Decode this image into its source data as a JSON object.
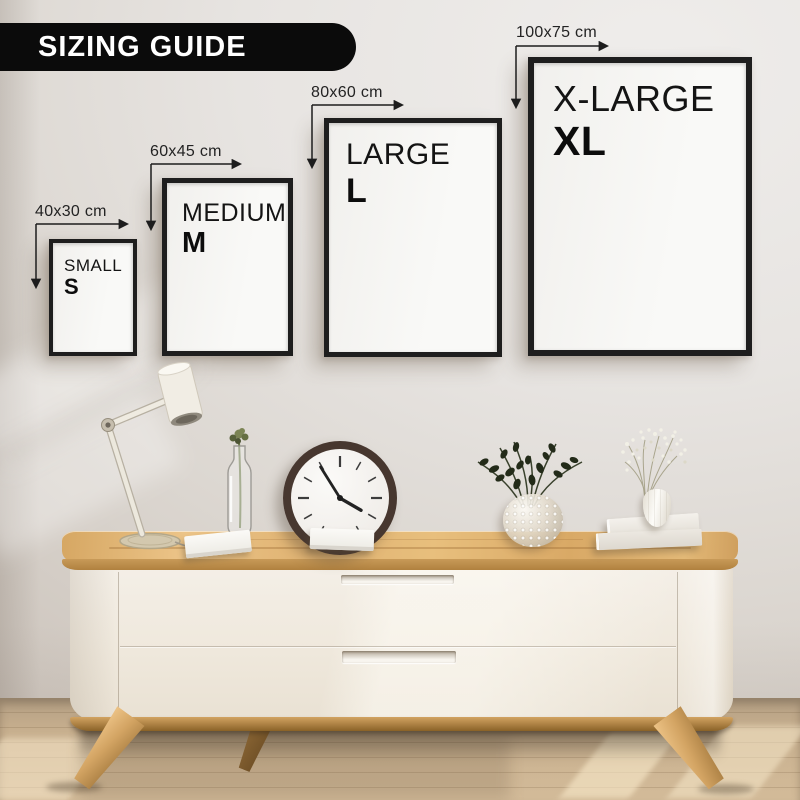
{
  "title_banner": {
    "label": "SIZING GUIDE"
  },
  "frames": [
    {
      "name": "SMALL",
      "letter": "S",
      "dimension": "40x30 cm"
    },
    {
      "name": "MEDIUM",
      "letter": "M",
      "dimension": "60x45 cm"
    },
    {
      "name": "LARGE",
      "letter": "L",
      "dimension": "80x60 cm"
    },
    {
      "name": "X-LARGE",
      "letter": "XL",
      "dimension": "100x75 cm"
    }
  ],
  "scene": {
    "wall_clock": {
      "approx_time": "4:55"
    },
    "decor_items": [
      "desk-lamp",
      "stem-in-glass-bottle",
      "wall-clock",
      "notebook",
      "notebook",
      "bubble-glass-vase-with-dark-foliage",
      "stacked-books",
      "white-vase-with-babys-breath"
    ],
    "furniture": "wooden-top-white-sideboard"
  },
  "colors": {
    "banner_bg": "#0b0b0b",
    "banner_text": "#ffffff",
    "frame_border": "#1e1e1e",
    "frame_fill": "#f7f6f3",
    "annotation_text": "#232323",
    "wall": "#e4e1dd",
    "wood_top": "#ddae6c",
    "cabinet_body": "#f0e9df",
    "floor": "#c9b091"
  }
}
